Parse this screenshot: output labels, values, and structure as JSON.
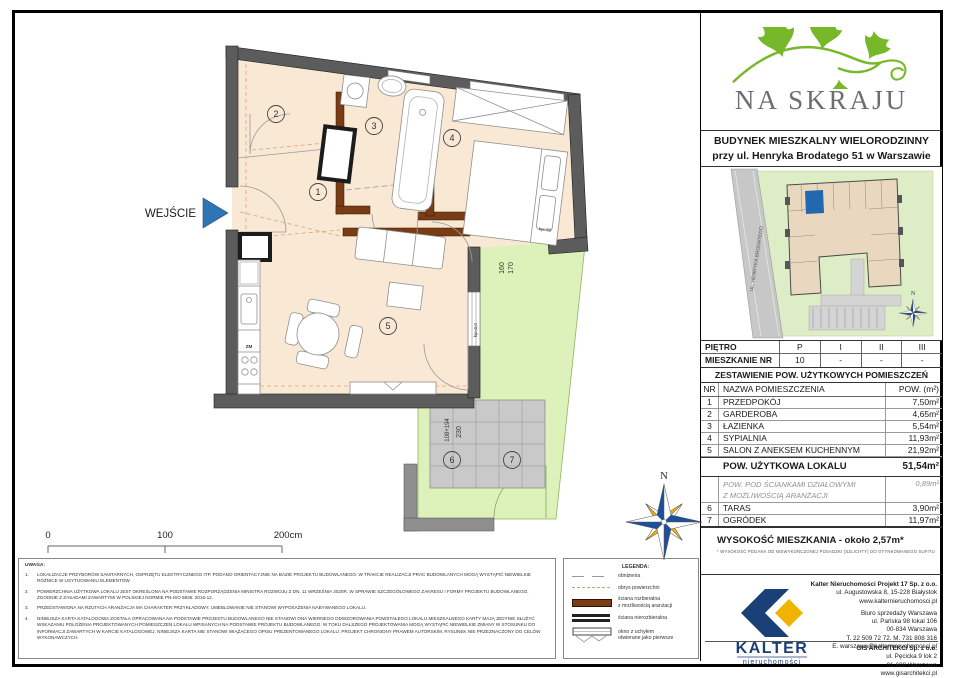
{
  "plan": {
    "entrance_label": "WEJŚCIE",
    "room_numbers": [
      "1",
      "2",
      "3",
      "4",
      "5",
      "6",
      "7"
    ],
    "dims": {
      "d160": "160",
      "d170": "170",
      "d108": "108+194",
      "d230": "230",
      "hp1": "hp=60",
      "hp2": "hp=0,0"
    },
    "kitchen_zm": "ZM",
    "compass_n": "N"
  },
  "scalebar": {
    "t0": "0",
    "t100": "100",
    "t200": "200cm"
  },
  "notes": {
    "title": "UWAGA:",
    "items": [
      {
        "n": "1.",
        "text": "LOKALIZACJE PRZYBORÓW SANITARNYCH, OSPRZĘTU ELEKTRYCZNEGO ITP. PODANO ORIENTACYJNIE NA BAZIE PROJEKTU BUDOWLANEGO. W TRAKCIE REALIZACJI PRAC BUDOWLANYCH MOGĄ WYSTĄPIĆ NIEWIELKIE RÓŻNICE W USYTUOWANIU ELEMENTÓW."
      },
      {
        "n": "2.",
        "text": "POWIERZCHNIA UŻYTKOWA LOKALU JEST OKREŚLONA NA PODSTAWIE ROZPORZĄDZENIA MINISTRA ROZWOJU Z DN. 11 WRZEŚNIA 2020R. W SPRAWIE SZCZEGÓŁOWEGO ZAKRESU I FORMY PROJEKTU BUDOWLANEGO, ZGODNIE Z ZASADAMI ZAWARTYMI W POLSKIEJ NORMIE PN-ISO 9836: 2015-12."
      },
      {
        "n": "3.",
        "text": "PRZEDSTAWIONA NA RZUTACH ARANŻACJA MA CHARAKTER PRZYKŁADOWY. UMEBLOWANIE NIE STANOWI WYPOSAŻENIA NABYWANEGO LOKALU."
      },
      {
        "n": "4.",
        "text": "NINIEJSZA KARTA KATALOGOWA ZOSTAŁA OPRACOWANA NA PODSTAWIE PROJEKTU BUDOWLANEGO NIE STANOWI ONA WIERNEGO ODWZOROWANIA POWSTAŁEGO LOKALU MIESZKALNEGO KARTY MAJĄ JEDYNIE SŁUŻYĆ WSKAZANIU POŁOŻENIA PROJEKTOWANYCH POMIESZCZEŃ LOKALU WPISANYCH NA PODSTAWIE PROJEKTU BUDOWLANEGO. W TOKU DALSZEGO PROJEKTOWANIA MOGĄ WYSTĄPIĆ NIEWIELKIE ZMIANY W STOSUNKU DO INFORMACJI ZAWARTYCH W KARCIE KATALOGOWEJ. NINIEJSZA KARTA NIE STANOWI WIĄŻĄCEGO OPISU PREZENTOWANEGO LOKALU. PROJEKT CHRONIONY PRAWEM AUTORSKIM. RYSUNEK NIE PRZEZNACZONY DO CELÓW WYKONAWCZYCH."
      }
    ]
  },
  "legend": {
    "title": "LEGENDA:",
    "items": [
      {
        "label": "obniżenia"
      },
      {
        "label": "obrys powierzchni"
      },
      {
        "label": "ściana rozbieralna\nz możliwością aranżacji"
      },
      {
        "label": "ściana nierozbieralna"
      },
      {
        "label": "okno z uchyłem\notwierane jako pierwsze"
      }
    ]
  },
  "panel": {
    "brand": "NA SKRAJU",
    "building_title_1": "BUDYNEK MIESZKALNY WIELORODZINNY",
    "building_title_2": "przy ul. Henryka Brodatego 51 w Warszawie",
    "siteplan": {
      "street": "UL. HENRYKA BRODATEGO",
      "compass_n": "N"
    },
    "floor_table": {
      "row1": [
        "PIĘTRO",
        "P",
        "I",
        "II",
        "III"
      ],
      "row2": [
        "MIESZKANIE NR",
        "10",
        "-",
        "-",
        "-"
      ]
    },
    "rooms_title": "ZESTAWIENIE POW. UŻYTKOWYCH POMIESZCZEŃ",
    "rooms_header": {
      "nr": "NR",
      "name": "NAZWA POMIESZCZENIA",
      "area": "POW. (m²)"
    },
    "rooms": [
      {
        "nr": "1",
        "name": "PRZEDPOKÓJ",
        "area": "7,50m²"
      },
      {
        "nr": "2",
        "name": "GARDEROBA",
        "area": "4,65m²"
      },
      {
        "nr": "3",
        "name": "ŁAZIENKA",
        "area": "5,54m²"
      },
      {
        "nr": "4",
        "name": "SYPIALNIA",
        "area": "11,93m²"
      },
      {
        "nr": "5",
        "name": "SALON Z ANEKSEM KUCHENNYM",
        "area": "21,92m²"
      }
    ],
    "total_label": "POW. UŻYTKOWA LOKALU",
    "total_area": "51,54m²",
    "partition_label": "POW. POD ŚCIANKAMI DZIAŁOWYMI\nZ MOŻLIWOŚCIĄ ARANŻACJI",
    "partition_area": "0,89m²",
    "extra_rooms": [
      {
        "nr": "6",
        "name": "TARAS",
        "area": "3,90m²"
      },
      {
        "nr": "7",
        "name": "OGRÓDEK",
        "area": "11,97m²"
      }
    ],
    "height_label": "WYSOKOŚĆ MIESZKANIA - około 2,57m*",
    "height_note": "* WYSOKOŚĆ PODANA OD NIEWYKOŃCZONEJ POSADZKI (SZLICHTY) DO OTYNKOWANEGO SUFITU",
    "kalter": {
      "logo_text": "KALTER",
      "logo_sub": "nieruchomości",
      "l1": "Kalter Nieruchomości Projekt 17 Sp. z o.o.",
      "l2": "ul. Augustowska 8, 15-228 Białystok",
      "l3": "www.kalternieruchomosci.pl",
      "l4": "Biuro sprzedaży Warszawa",
      "l5": "ul. Pańska 98 lokal 106",
      "l6": "00-834 Warszawa",
      "l7": "T. 22 509 72 72. M. 731 808 316",
      "l8": "E. warszawa@kalternieruchomosci.pl"
    },
    "gis": {
      "l1": "GIS ARCHITEKCI Sp. z o.o.",
      "l2": "ul. Pęcicka 9 lok 2",
      "l3": "01-688 Warszawa",
      "l4": "www.gisarchitekci.pl"
    }
  }
}
